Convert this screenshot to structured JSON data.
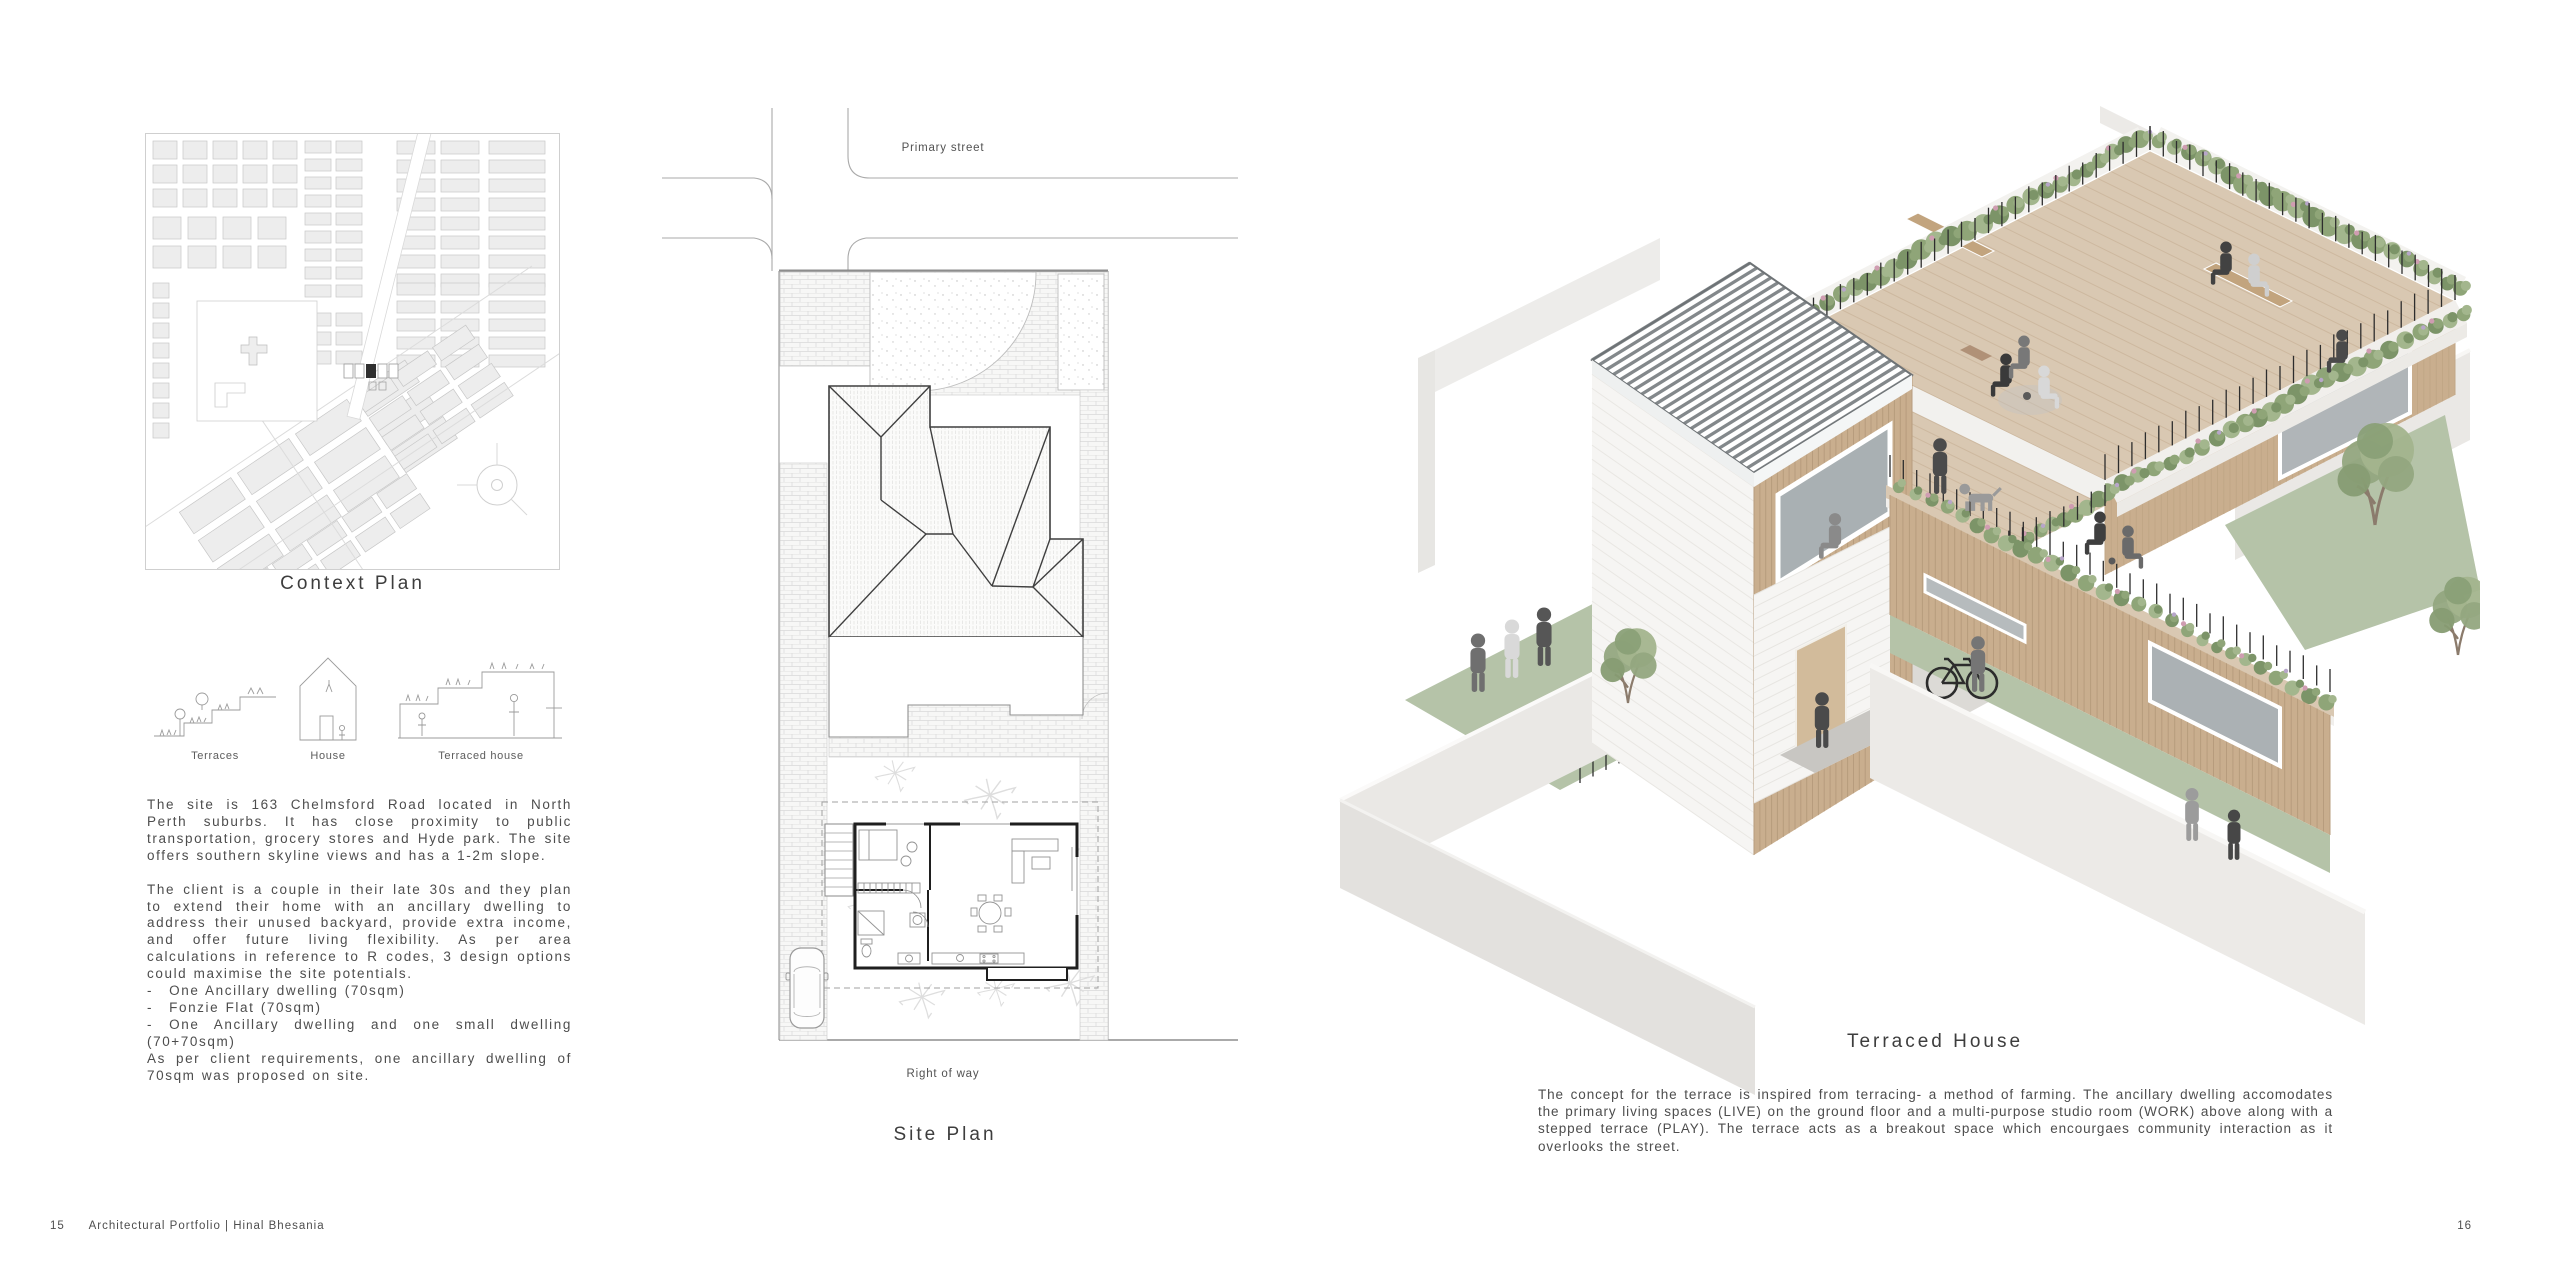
{
  "page_left": {
    "context_plan_label": "Context Plan",
    "sketches": [
      {
        "label": "Terraces"
      },
      {
        "label": "House"
      },
      {
        "label": "Terraced house"
      }
    ],
    "bullet": "-",
    "paragraph1": "The site is 163 Chelmsford Road located in North Perth suburbs. It has close proximity to public transportation, grocery stores and Hyde park. The site offers southern skyline views and has a 1-2m slope.",
    "paragraph2": "The client is a couple in their late 30s and they plan to extend their home with an ancillary dwelling to address their unused backyard, provide extra income, and offer future living flexibility. As per area calculations in reference to R codes, 3 design options could maximise the site potentials.",
    "options": [
      "One Ancillary dwelling (70sqm)",
      "Fonzie Flat (70sqm)",
      "One Ancillary dwelling and one small dwelling (70+70sqm)"
    ],
    "paragraph3": "As per client requirements, one ancillary dwelling of 70sqm was proposed on site.",
    "footer_page_number": "15",
    "footer_text": "Architectural Portfolio | Hinal Bhesania"
  },
  "site_plan": {
    "street_label": "Primary street",
    "row_label": "Right of way",
    "title": "Site Plan"
  },
  "page_right": {
    "title": "Terraced House",
    "description": "The concept for the terrace is inspired from terracing- a method of farming. The ancillary dwelling accomodates the primary living spaces (LIVE) on the ground floor and a multi-purpose studio room (WORK) above along with a stepped terrace (PLAY). The terrace acts as a breakout space which encourgaes community interaction as it overlooks the street.",
    "footer_page_number": "16"
  },
  "colors": {
    "deck": "#d9c8b2",
    "deck_line": "#cdb89f",
    "wood": "#c9ae8e",
    "lawn": "#b5c3a8",
    "foliage": "#8fa578",
    "foliage2": "#a3b68d",
    "foliage3": "#7c9468",
    "flower_pink": "#cf9db1",
    "roof_stripe": "#83888b",
    "wall": "#eae8e5",
    "glass": "#adb3b6",
    "line": "#9a9a9a",
    "ink": "#4d4d4d"
  }
}
